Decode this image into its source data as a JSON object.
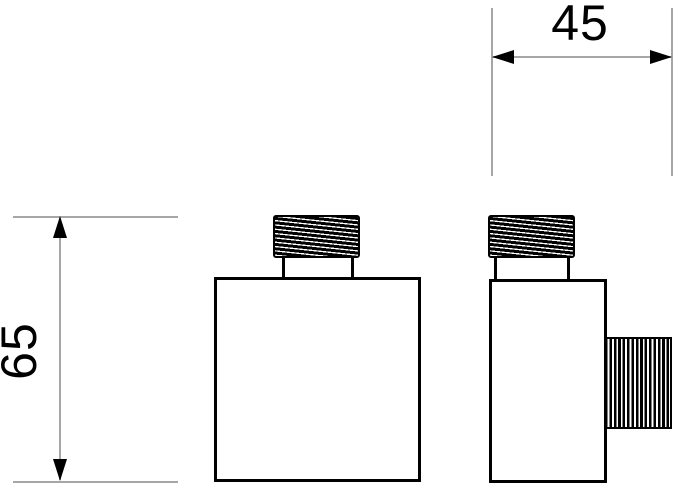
{
  "drawing": {
    "type": "technical-drawing-two-views",
    "dimensions": {
      "width_mm": "45",
      "height_mm": "65"
    },
    "colors": {
      "outline": "#000000",
      "dimension_line": "#a6a6a6",
      "background": "#ffffff"
    }
  }
}
